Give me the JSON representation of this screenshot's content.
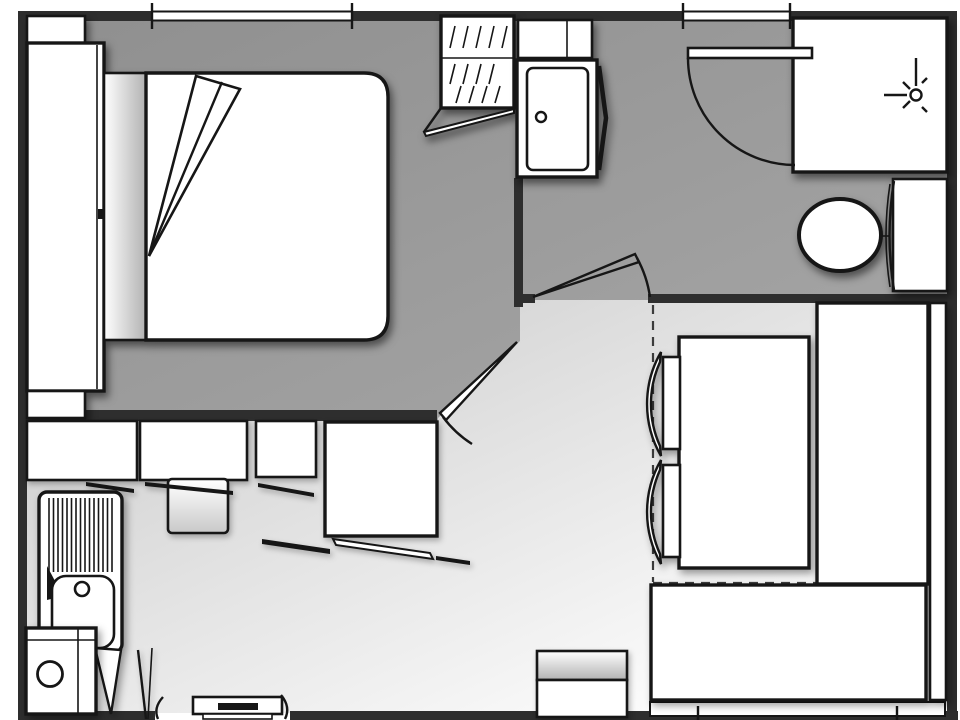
{
  "figure": {
    "type": "floor-plan",
    "subject": "small apartment / mobile-home floor plan, top view, no text labels",
    "canvas": {
      "width_px": 960,
      "height_px": 720
    }
  },
  "colors": {
    "wall": "#2e2e2e",
    "line": "#161616",
    "dash": "#3c3c3c",
    "furniture": "#ffffff",
    "floor_gray_a": "#8f8f8f",
    "floor_gray_b": "#a7a7a7",
    "floor_light_a": "#b6b6b6",
    "floor_light_b": "#fcfcfc"
  },
  "rooms": [
    {
      "name": "bedroom",
      "floor": "dark-gray",
      "items": [
        "double-bed",
        "folded-blanket",
        "headboard",
        "wardrobe",
        "top-shelf",
        "bottom-shelf",
        "window-top-wall",
        "open-door"
      ]
    },
    {
      "name": "hall-bathroom",
      "floor": "dark-gray",
      "items": [
        "linen-closet-with-hatching",
        "utility-cabinet-with-knob-door",
        "shower-cubicle-with-shower-head-symbol",
        "toilet-with-cistern",
        "entrance-door-with-swing-arc",
        "bathroom-door-with-swing-arc"
      ]
    },
    {
      "name": "living-kitchen",
      "floor": "light-gradient",
      "items": [
        "kitchen-cabinet-run",
        "tall-cabinet-block",
        "cooktop-unit",
        "sink-with-drainboard",
        "under-sink-appliance",
        "open-cabinet-door-wedges",
        "dining-table",
        "dining-chair",
        "dining-chair",
        "l-shaped-bench-seat",
        "bench-backrest-strip",
        "side-cabinet",
        "entry-step",
        "window-bottom-wall",
        "overhead-outline-dashed"
      ]
    }
  ],
  "openings": {
    "windows": [
      "top-left-window",
      "top-right-window",
      "bottom-right-window"
    ],
    "doors": [
      "entrance-door-top-right",
      "bathroom-door",
      "bedroom-door",
      "entry-gap-bottom-left"
    ]
  }
}
